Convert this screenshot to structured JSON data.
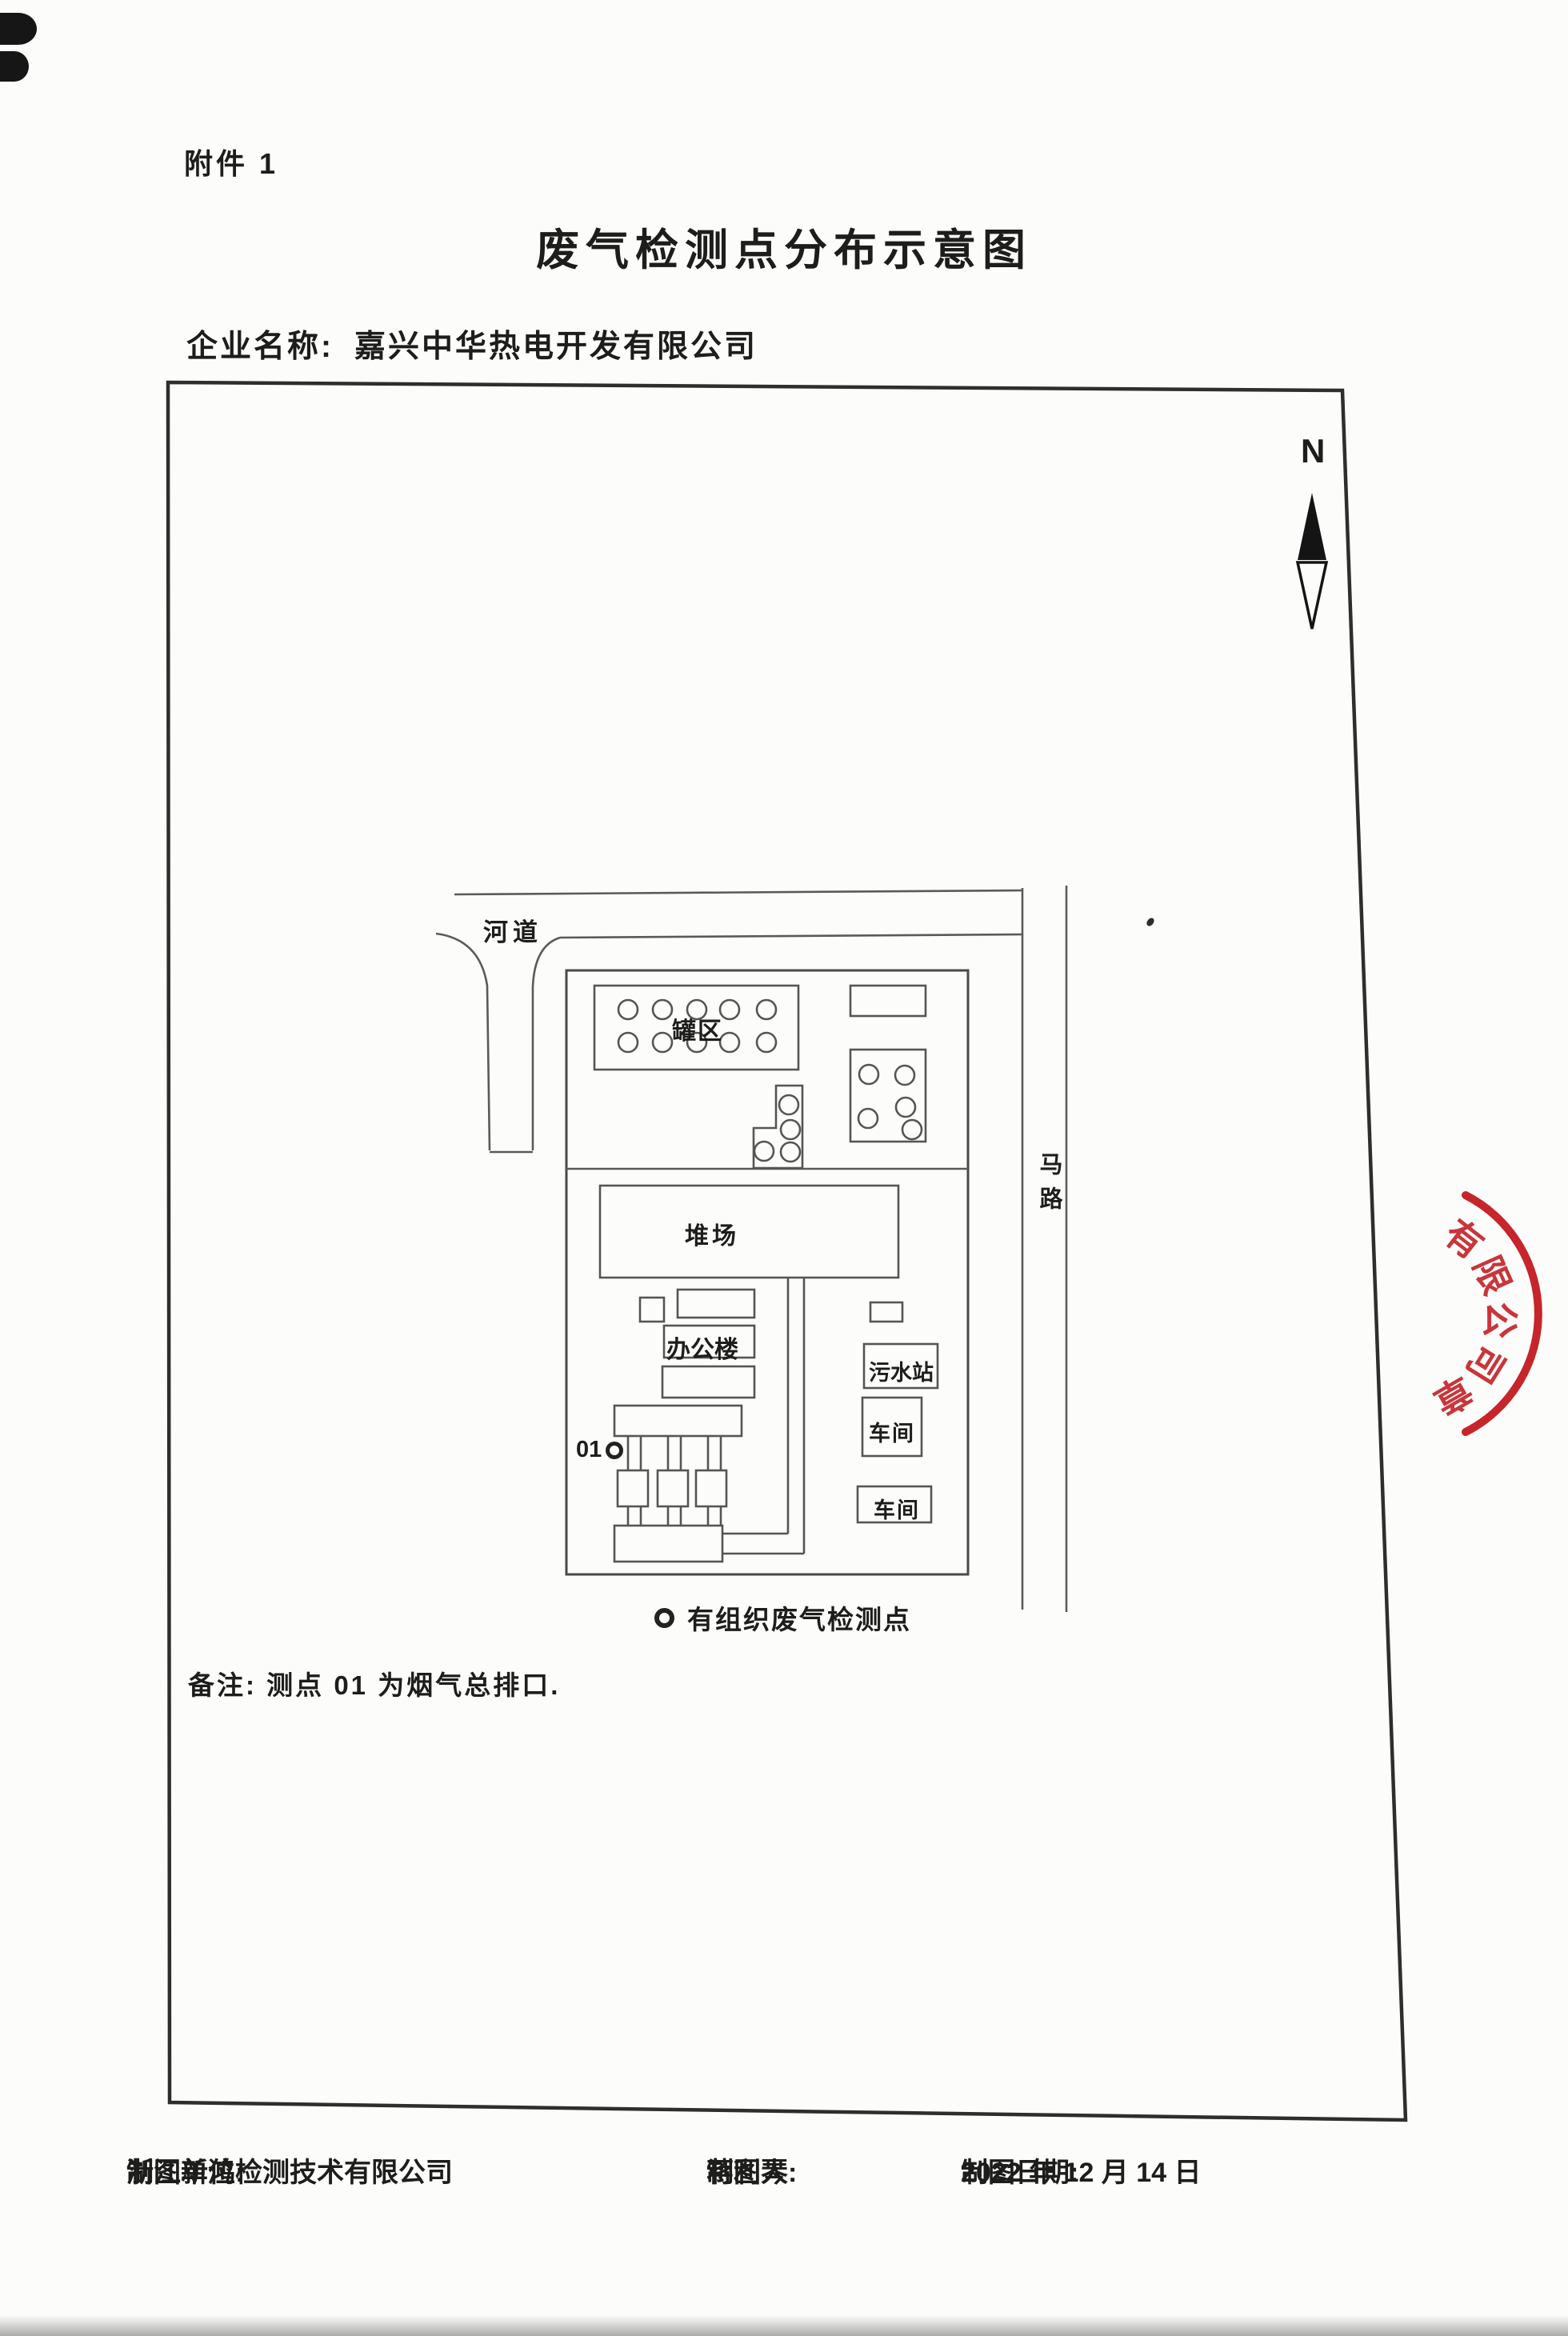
{
  "document": {
    "attachment": "附件 1",
    "title": "废气检测点分布示意图",
    "company_label": "企业名称:",
    "company_name": "嘉兴中华热电开发有限公司",
    "note": "备注: 测点 01 为烟气总排口.",
    "footer": {
      "unit_label": "制图单位:",
      "unit": "浙江新鸿检测技术有限公司",
      "drafter_label": "制图人:",
      "drafter": "蒋利琴",
      "date_label": "制图日期:",
      "date": "2022 年 12 月 14 日"
    }
  },
  "map": {
    "north": "N",
    "river": "河道",
    "road": "马路",
    "tank_area": "罐区",
    "stockyard": "堆场",
    "office": "办公楼",
    "sewage_station": "污水站",
    "workshop_1": "车间",
    "workshop_2": "车间",
    "point_id": "01",
    "legend_text": "有组织废气检测点"
  },
  "stamp": {
    "chars": [
      "有",
      "限",
      "公",
      "司",
      "章"
    ],
    "color": "#c5252b"
  },
  "colors": {
    "ink": "#1d1d1b",
    "diagram_line": "#555555",
    "border": "#2e2e2e",
    "stamp_red": "#c5252b"
  }
}
